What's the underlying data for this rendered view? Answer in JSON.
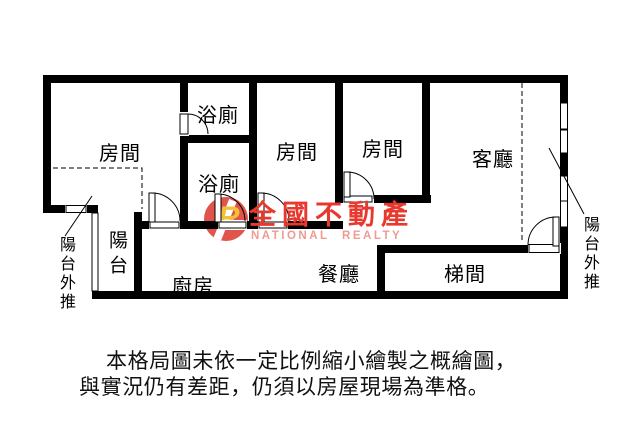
{
  "rooms": {
    "bedroom1": "房間",
    "bedroom2": "房間",
    "bedroom3": "房間",
    "bath1": "浴廁",
    "bath2": "浴廁",
    "living": "客廳",
    "kitchen": "廚房",
    "dining": "餐廳",
    "stair": "梯間",
    "balcony": "陽台"
  },
  "annotations": {
    "left": "陽台外推",
    "right": "陽台外推"
  },
  "watermark": {
    "logo_letter": "R",
    "brand": "全國不動產",
    "subtitle": "NATIONAL REALTY",
    "brand_color": "#e8392f",
    "subtitle_color": "#ef9b94",
    "logo_bg": "#e0544c",
    "logo_letter_color": "#f3c138"
  },
  "disclaimer": {
    "line1": "本格局圖未依一定比例縮小繪製之概繪圖，",
    "line2": "與實況仍有差距，仍須以房屋現場為準格。"
  },
  "colors": {
    "wall": "#000000",
    "background": "#ffffff",
    "text": "#000000"
  }
}
